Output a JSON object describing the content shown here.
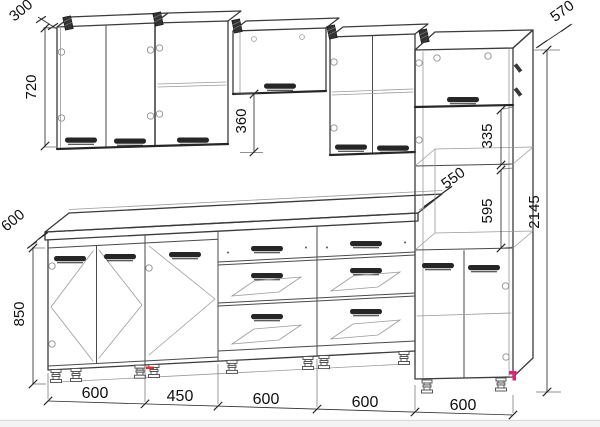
{
  "drawing": {
    "dimensions": {
      "wall_depth": "300",
      "wall_height": "720",
      "hood_gap_height": "360",
      "counter_depth": "600",
      "base_height": "850",
      "tall_depth": "570",
      "total_height": "2145",
      "tall_shelf_height": "335",
      "oven_niche_depth": "550",
      "oven_niche_height": "595",
      "module_widths": [
        "600",
        "450",
        "600",
        "600",
        "600"
      ]
    },
    "colors": {
      "outline": "#3b3b3b",
      "secondary": "#9a9a9a",
      "dimension_text": "#101010",
      "accent_pink": "#ea1a7a",
      "accent_red": "#e03131",
      "background": "#ffffff",
      "footer_strip": "#f3f3f3"
    }
  }
}
